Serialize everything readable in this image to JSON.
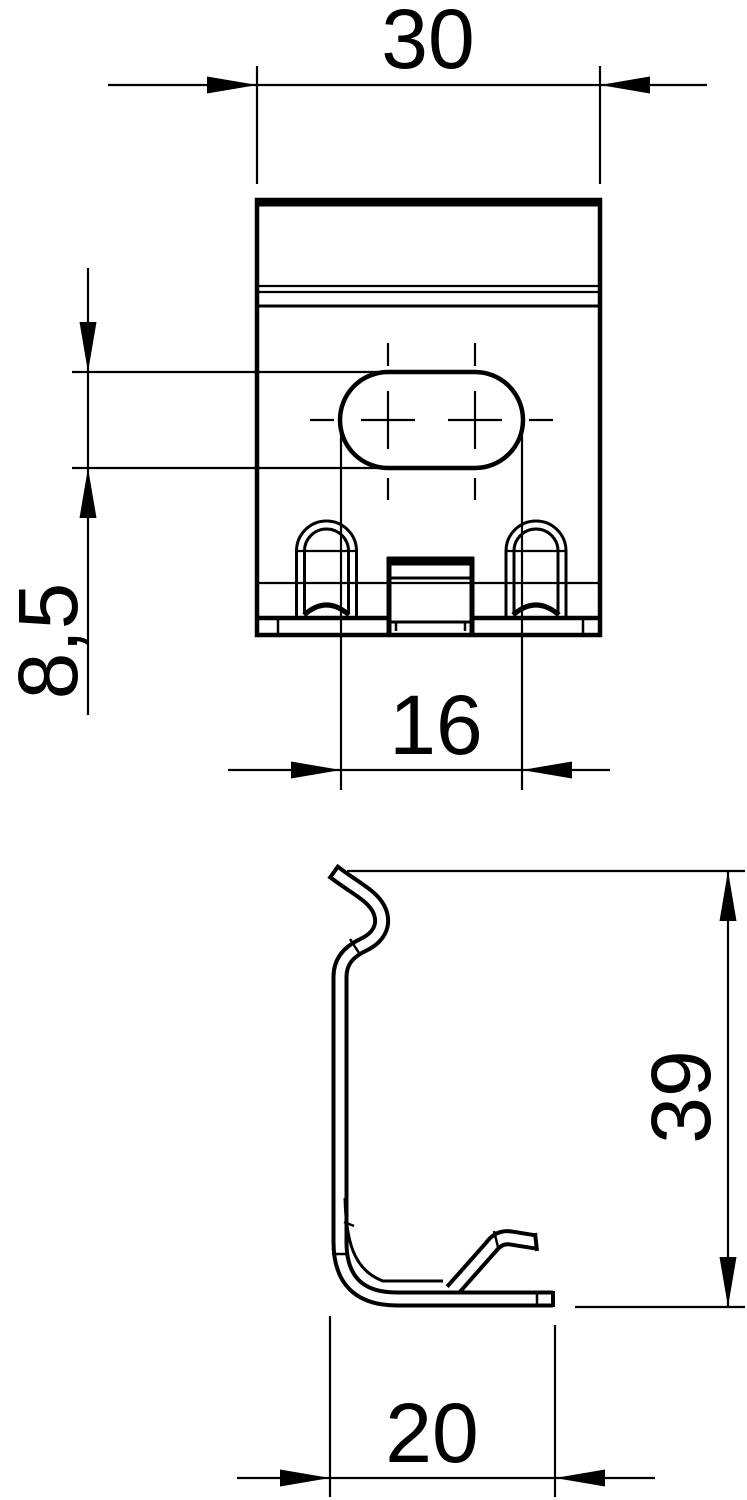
{
  "document": {
    "type": "technical-drawing",
    "background": "#ffffff",
    "line_color": "#000000",
    "views": {
      "top_view": "clamp top view with oblong slot, two arched lugs and center tab",
      "side_view": "clamp side profile with hook top, L-foot and kick-up tab"
    }
  },
  "dimensions": {
    "top_width": {
      "value": "30"
    },
    "slot_height": {
      "value": "8,5"
    },
    "slot_length": {
      "value": "16"
    },
    "side_height": {
      "value": "39"
    },
    "side_depth": {
      "value": "20"
    }
  }
}
